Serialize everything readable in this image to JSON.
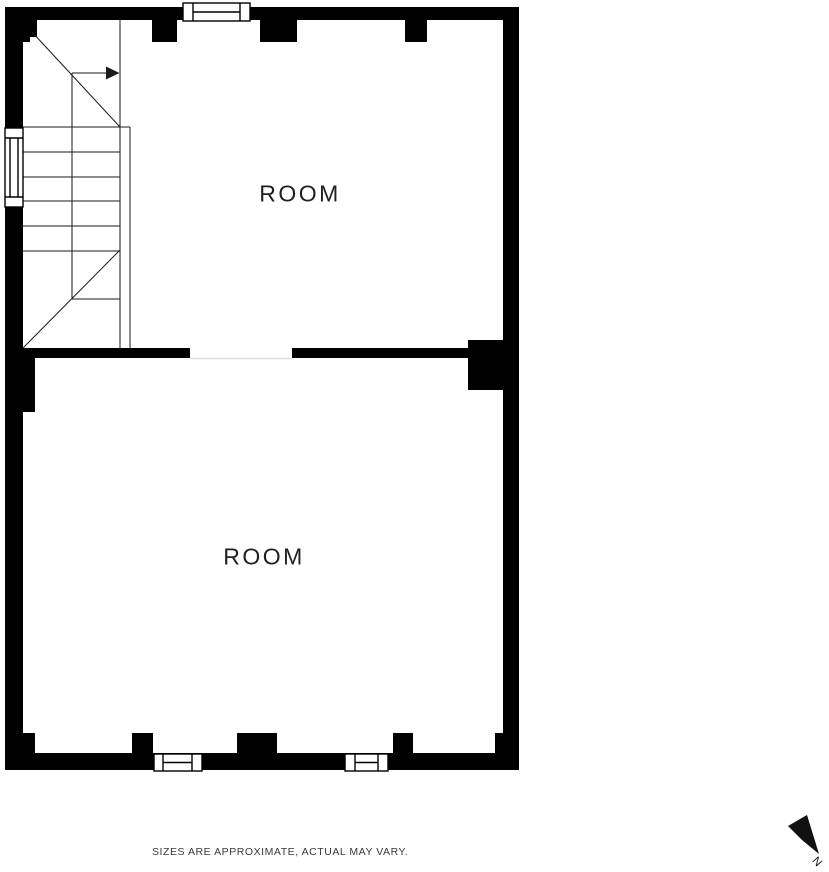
{
  "floor_plan": {
    "rooms": [
      {
        "label": "ROOM"
      },
      {
        "label": "ROOM"
      }
    ],
    "colors": {
      "wall": "#000000",
      "background": "#ffffff",
      "stair_line": "#1a1a1a",
      "door_threshold": "#e0e0e0",
      "room_label": "#1f1f1f",
      "disclaimer_text": "#3a3a3a"
    }
  },
  "footer": {
    "disclaimer": "SIZES ARE APPROXIMATE, ACTUAL MAY VARY."
  },
  "compass": {
    "north_label": "N"
  }
}
